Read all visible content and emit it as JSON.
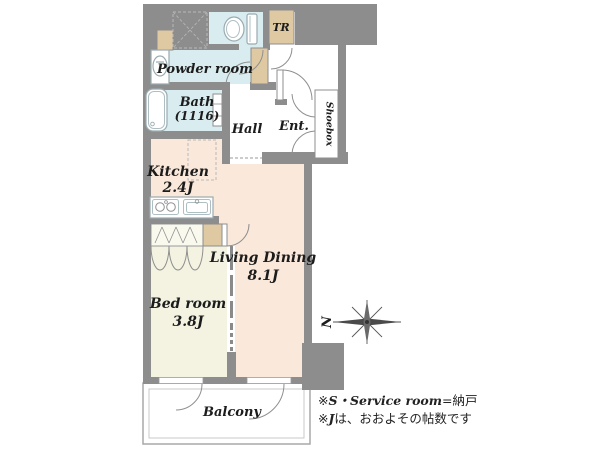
{
  "rooms": {
    "tr": "TR",
    "powder": "Powder room",
    "bath": "Bath",
    "bath_size": "(1116)",
    "hall": "Hall",
    "ent": "Ent.",
    "shoebox": "Shoebox",
    "kitchen": "Kitchen",
    "kitchen_size": "2.4J",
    "living": "Living Dining",
    "living_size": "8.1J",
    "bedroom": "Bed room",
    "bedroom_size": "3.8J",
    "balcony": "Balcony"
  },
  "compass": {
    "north": "N"
  },
  "notes": {
    "n1_mark": "※",
    "n1_italic": "S・Service room",
    "n1_rest": "=納戸",
    "n2_mark": "※",
    "n2_italic": "J",
    "n2_rest": "は、おおよその帖数です"
  },
  "colors": {
    "wall_gray": "#8d8d8d",
    "wet_room_blue": "#d9edf0",
    "ldk_peach": "#fae8da",
    "bedroom_cream": "#f4f3e2",
    "storage_tan": "#dfc9a2",
    "background": "#ffffff",
    "label_text": "#1c1c1c"
  }
}
